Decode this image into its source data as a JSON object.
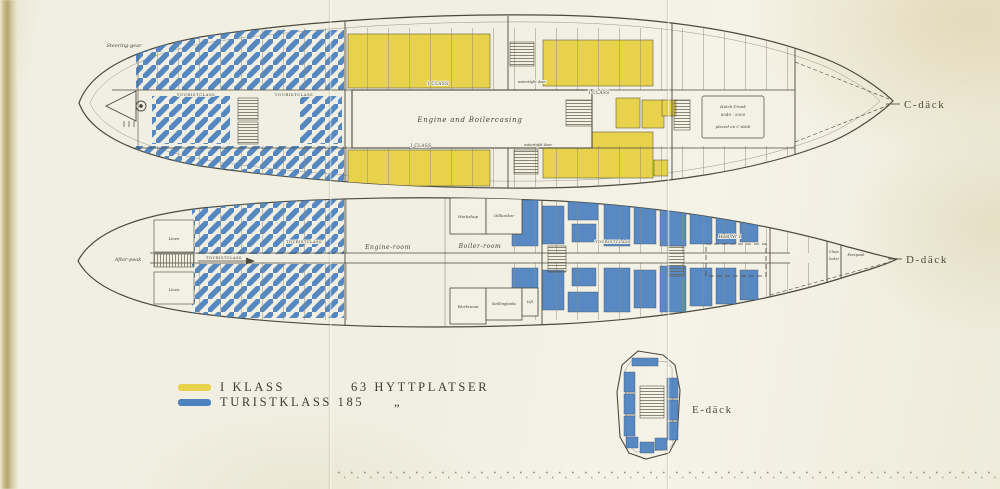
{
  "colors": {
    "first_class": "#e8d24b",
    "tourist_class": "#4d82c0",
    "paper": "#f1efe1",
    "ink": "#4c493d"
  },
  "legend": {
    "rows": [
      {
        "label": "I KLASS",
        "berths": "63 HYTTPLATSER",
        "color_key": "first_class"
      },
      {
        "label": "TURISTKLASS 185",
        "berths": "„",
        "color_key": "tourist_class"
      }
    ]
  },
  "deck_c": {
    "name": "C-däck",
    "labels": {
      "steering_gear": "Steering-gear",
      "touristclass_1": "TOURISTCLASS",
      "touristclass_2": "TOURISTCLASS",
      "i_class_top": "I CLASS",
      "i_class_bottom": "I CLASS",
      "i_class_right": "I CLASS",
      "engine_casing": "Engine and Boilercasing",
      "watertight_top": "watertight door",
      "watertight_bottom": "watertight door",
      "hatch_note_1": "Hatch-Trunk",
      "hatch_note_2": "6049 - 5000",
      "hatch_note_3": "placed on C-däck"
    }
  },
  "deck_d": {
    "name": "D-däck",
    "labels": {
      "after_peak": "After-peak",
      "linen_1": "Linen",
      "linen_2": "Linen",
      "touristclass_1": "TOURISTCLASS",
      "touristclass_2": "TOURISTCLASS",
      "touristclass_3": "TOURISTCLASS",
      "engine_room": "Engine-room",
      "boiler_room": "Boiler-room",
      "workshop": "Workshop",
      "oilbunker": "Oilbunker",
      "workroom": "Workroom",
      "settlingtanks": "Settlingtanks",
      "lift": "Lift",
      "hold": "Hold Nr 1",
      "chain_locker_1": "Chain",
      "chain_locker_2": "locker",
      "forepeak": "Forepeak"
    }
  },
  "deck_e": {
    "name": "E-däck"
  }
}
